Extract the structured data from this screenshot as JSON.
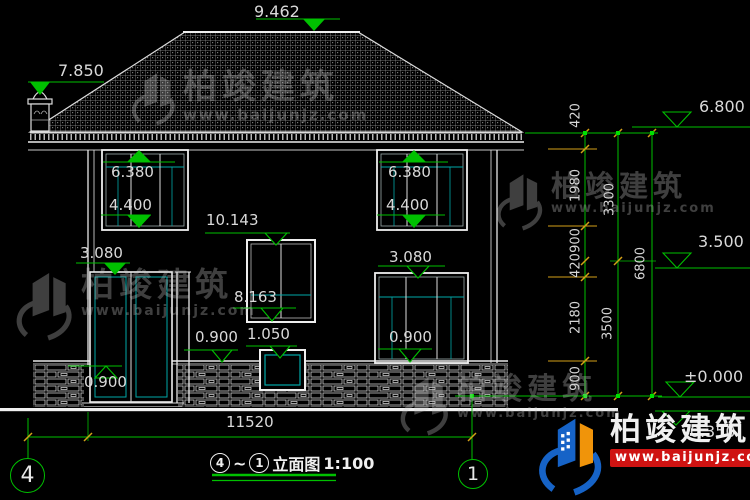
{
  "watermark": {
    "brand": "柏竣建筑",
    "url": "www.baijunjz.com"
  },
  "levels": {
    "ridge": "9.462",
    "left_eave": "7.850",
    "right_eave": "6.800",
    "mid": "3.500",
    "zero": "±0.000",
    "minus": "-0.350"
  },
  "elevation_marks": {
    "upper_left_head": "6.380",
    "upper_left_sill": "4.400",
    "upper_right_head": "6.380",
    "upper_right_sill": "4.400",
    "stair_head": "10.143",
    "stair_sill": "8.163",
    "door_head": "3.080",
    "gf_window_head": "3.080",
    "gf_window_sill": "0.900",
    "small_window_sill": "1.050",
    "porch_sill": "0.900",
    "base_left": "0.900"
  },
  "dim_chains": {
    "inner": [
      "420",
      "1980",
      "900",
      "420",
      "2180",
      "900"
    ],
    "middle": [
      "3300",
      "3500"
    ],
    "outer": [
      "6800"
    ]
  },
  "footer": {
    "overall_width": "11520",
    "axis_left": "4",
    "axis_right": "1",
    "title_from": "4",
    "title_tilde": "~",
    "title_to": "1",
    "title_text": "立面图",
    "title_scale": "1:100"
  },
  "colors": {
    "background": "#000000",
    "line_white": "#e8e8e8",
    "line_green": "#00c000",
    "line_cyan": "#00a8a8",
    "tick_orange": "#d4a017",
    "logo_blue": "#1663c7",
    "logo_orange": "#f0940a",
    "url_red": "#cf1312"
  }
}
